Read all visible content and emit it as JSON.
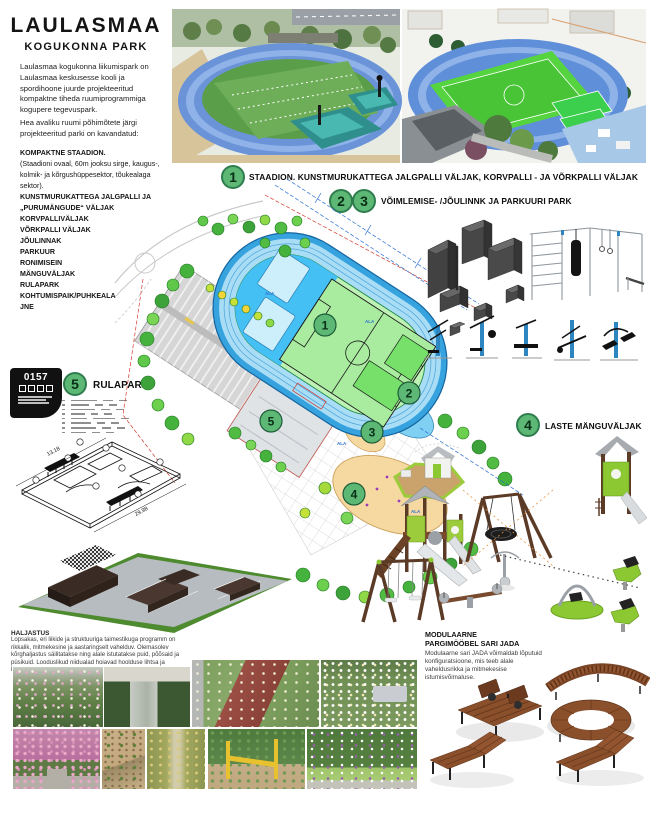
{
  "title": "LAULASMAA",
  "subtitle": "KOGUKONNA PARK",
  "intro_p1": "Laulasmaa kogukonna liikumispark on Laulasmaa keskusesse kooli ja spordihoone juurde projekteeritud kompaktne tiheda ruumiprogrammiga kogupere tegevuspark.",
  "intro_p2": "Hea avaliku ruumi põhimõtete järgi projekteeritud parki on kavandatud:",
  "features": [
    "KOMPAKTNE STAADION.",
    "(Staadioni ovaal, 60m jooksu sirge, kaugus-, kolmik- ja kõrgushüppesektor, tõukealaga sektor).",
    "KUNSTMURUKATTEGA JALGPALLI JA „PURUMÄNGUDE“ VÄLJAK",
    "KORVPALLIVÄLJAK",
    "VÕRKPALLI VÄLJAK",
    "JÕULINNAK",
    "PARKUUR",
    "RONIMISEIN",
    "MÄNGUVÄLJAK",
    "RULAPARK",
    "KOHTUMISPAIK/PUHKEALA",
    "JNE"
  ],
  "labels": {
    "l1_num": "1",
    "l1_text": "STAADION. KUNSTMURUKATTEGA JALGPALLI VÄLJAK, KORVPALLI - JA VÕRKPALLI VÄLJAK",
    "l2_num": "2",
    "l3_num": "3",
    "l23_text": "VÕIMLEMISE- /JÕULINNK JA PARKUURI PARK",
    "l4_num": "4",
    "l4_text": "LASTE MÄNGUVÄLJAK",
    "l5_num": "5",
    "l5_text": "RULAPARK"
  },
  "plan": {
    "badges": [
      "1",
      "2",
      "3",
      "4",
      "5"
    ],
    "area_label": "ALA"
  },
  "stamp": {
    "code": "0157"
  },
  "skate_drawing": {
    "dim_left": "13,18",
    "dim_bottom": "29,98"
  },
  "haljastus": {
    "heading": "HALJASTUS",
    "body": "Lopsakas, eri liikide ja struktuuriga taimestikuga programm on rikkalik, mitmekesine ja aastaringselt vahelduv. Olemasolev kõrghaljastus säilitatakse ning alale istutatakse puid, põõsaid ja püsikuid. Looduslikud niidualad hoiavad hoolduse lihtsa ja keskkonna liigirikka."
  },
  "furniture": {
    "h1": "MODULAARNE",
    "h2": "PARGIMÖÖBEL SARI JADA",
    "body": "Modulaarne sari JADA võimaldab lõputuid konfiguratsioone, mis teeb alale vaheldusrikka ja mitmekesise istumisvõimaluse."
  },
  "colors": {
    "badge_green": "#5cb874",
    "track_blue": "#36a3df",
    "field_green": "#bdf2b4",
    "render_green": "#55c244",
    "equipment_gray": "#474747",
    "wood": "#8a4f2b"
  }
}
